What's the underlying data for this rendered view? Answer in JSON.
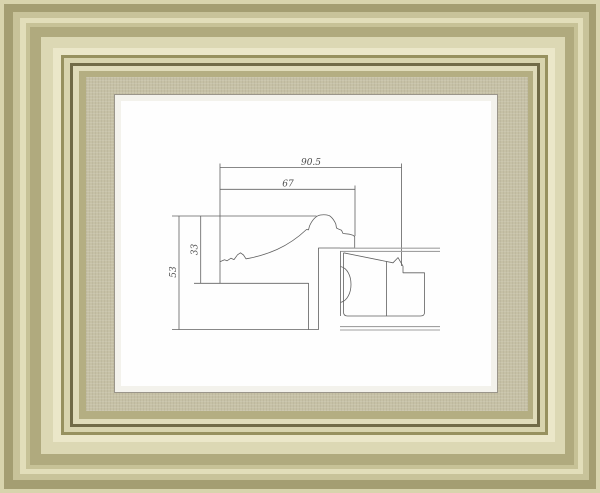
{
  "drawing": {
    "dimensions": {
      "total_width": "90.5",
      "face_width": "67",
      "total_height": "53",
      "face_height": "33"
    }
  },
  "colors": {
    "frame_gold_dark": "#a49e72",
    "frame_gold_light": "#ebe7c9",
    "frame_shadow_line": "#716b47",
    "mat_linen": "#c6c1a6",
    "liner_white": "#f3f2ec",
    "drawing_line": "#606060",
    "panel_line": "#a0a0a0",
    "artwork_background": "#fefefe"
  }
}
